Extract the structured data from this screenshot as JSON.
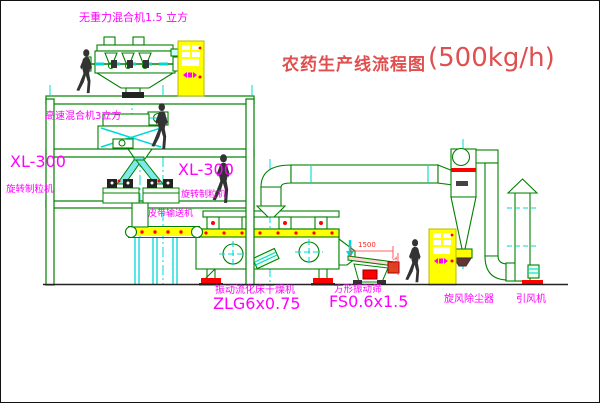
{
  "title": {
    "name": "农药生产线流程图",
    "capacity": "(500kg/h)"
  },
  "equipment": {
    "no_gravity_mixer": "无重力混合机1.5 立方",
    "high_speed_mixer": "高速混合机3立方",
    "granulator_left_model": "XL-300",
    "granulator_left_name": "旋转制粒机",
    "granulator_right_model": "XL-300",
    "granulator_right_name": "旋转制粒机",
    "belt_conveyor": "皮带输送机",
    "dryer_name": "振动流化床干燥机",
    "dryer_model": "ZLG6x0.75",
    "sieve_name": "方形振动筛",
    "sieve_model": "FS0.6x1.5",
    "dust_collector": "旋风除尘器",
    "induced_draft_fan": "引风机"
  },
  "dimensions": {
    "sieve_length": "1500",
    "sieve_outlet_height": "350"
  },
  "colors": {
    "line_green": "#008000",
    "centerline_cyan": "#00d8d8",
    "label_magenta": "#ff00ff",
    "accent_red": "#ff0000",
    "cabinet_yellow": "#ffff00",
    "title_red": "#e04f4f"
  }
}
